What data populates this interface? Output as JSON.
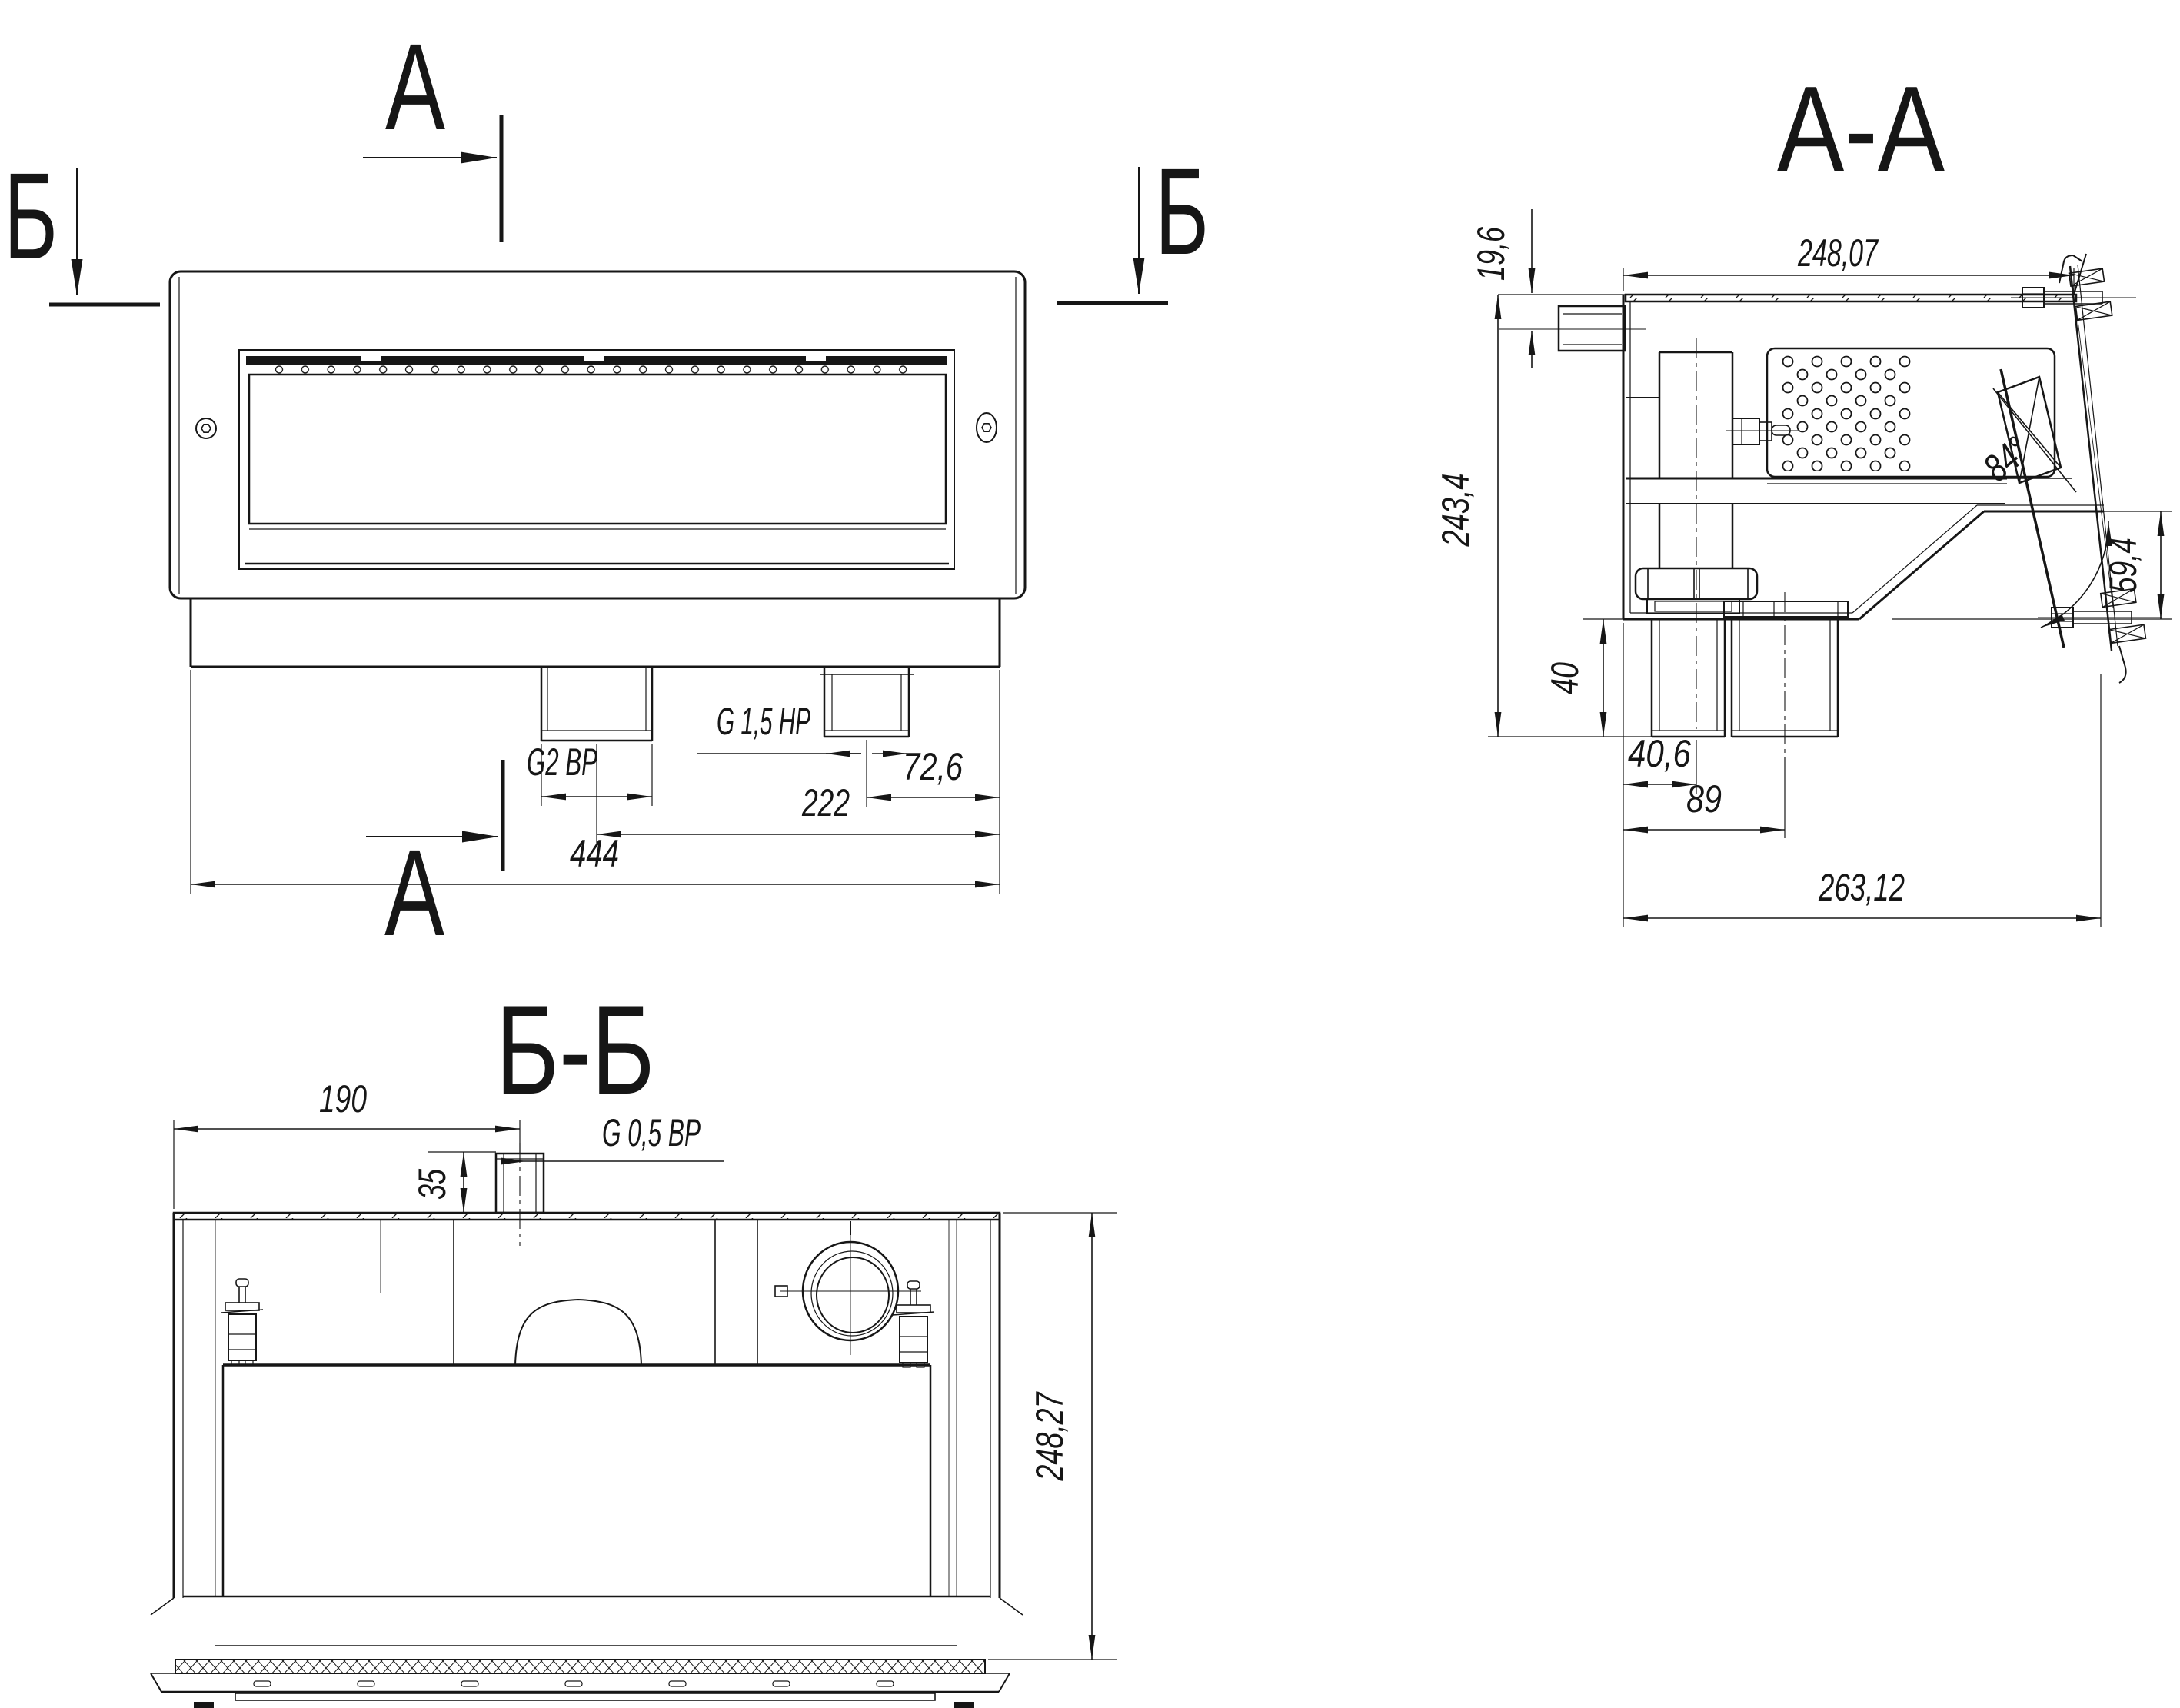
{
  "meta": {
    "background": "#ffffff",
    "ink_color": "#161616",
    "drawing_type": "technical-section-drawing"
  },
  "front_view": {
    "cut_a_top": "А",
    "cut_a_bottom": "А",
    "cut_b_left": "Б",
    "cut_b_right": "Б",
    "thread_g2": "G2 ВР",
    "thread_g15": "G 1,5 НР",
    "dim_72_6": "72,6",
    "dim_222": "222",
    "dim_444": "444"
  },
  "section_aa": {
    "title": "А-А",
    "dim_248_07": "248,07",
    "dim_19_6": "19,6",
    "dim_243_4": "243,4",
    "dim_40": "40",
    "dim_40_6": "40,6",
    "dim_89": "89",
    "dim_263_12": "263,12",
    "dim_59_4": "59,4",
    "angle_84": "84°"
  },
  "section_bb": {
    "title": "Б-Б",
    "dim_190": "190",
    "dim_35": "35",
    "thread_g05": "G 0,5 ВР",
    "dim_248_27": "248,27"
  }
}
